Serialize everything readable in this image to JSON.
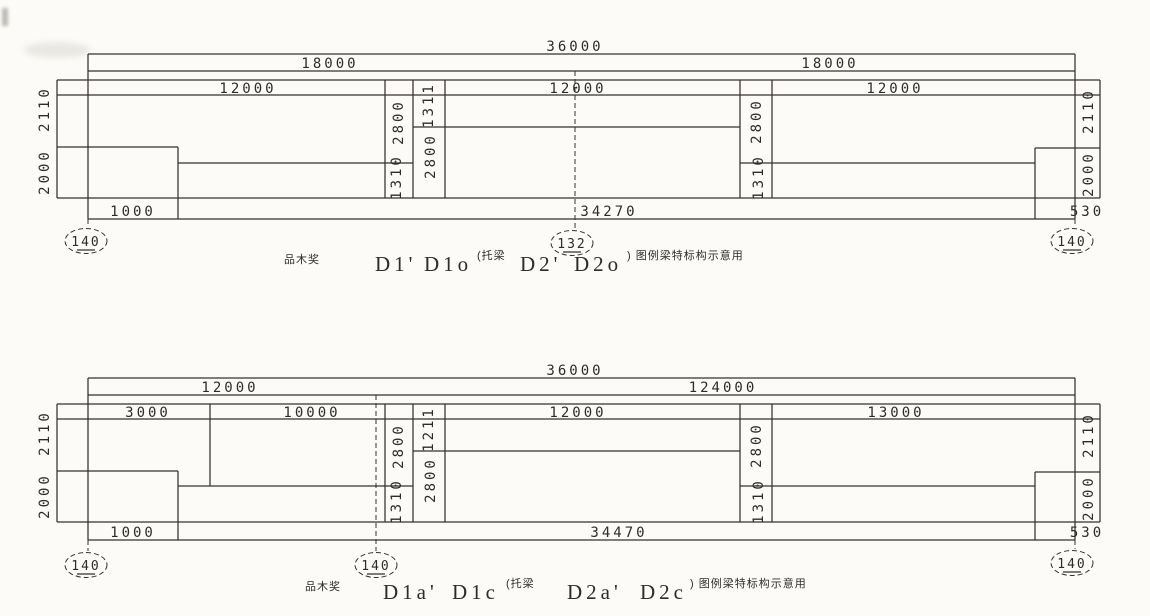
{
  "colors": {
    "background": "#fcfbf8",
    "ink": "#2e2c2a",
    "line": "#34312e"
  },
  "drawings": [
    {
      "overall_span": "36000",
      "row2": [
        "18000",
        "18000"
      ],
      "row3": [
        "12000",
        "12000",
        "12000"
      ],
      "left_heights": [
        "2110",
        "2000"
      ],
      "strip_a": [
        "2800",
        "1310"
      ],
      "strip_b": [
        "1311",
        "2800"
      ],
      "right_strip": [
        "2800",
        "1310"
      ],
      "right_heights": [
        "2110",
        "2000"
      ],
      "bottom_spans": [
        "1000",
        "34270",
        "530"
      ],
      "bubbles": [
        "140",
        "132",
        "140"
      ],
      "caption": {
        "prefix": "品木奖",
        "labels": [
          "D1'",
          "D1o",
          "D2'",
          "D2o"
        ],
        "note_open": "(托梁",
        "note_close": ") 图例梁特标构示意用"
      }
    },
    {
      "overall_span": "36000",
      "row2": [
        "12000",
        "124000"
      ],
      "row3": [
        "3000",
        "10000",
        "12000",
        "13000"
      ],
      "left_heights": [
        "2110",
        "2000"
      ],
      "strip_a": [
        "2800",
        "1310"
      ],
      "strip_b": [
        "1211",
        "2800"
      ],
      "right_strip": [
        "2800",
        "1310"
      ],
      "right_heights": [
        "2110",
        "2000"
      ],
      "bottom_spans": [
        "1000",
        "34470",
        "530"
      ],
      "bubbles": [
        "140",
        "140",
        "140"
      ],
      "caption": {
        "prefix": "品木奖",
        "labels": [
          "D1a'",
          "D1c",
          "D2a'",
          "D2c"
        ],
        "note_open": "(托梁",
        "note_close": ") 图例梁特标构示意用"
      }
    }
  ]
}
